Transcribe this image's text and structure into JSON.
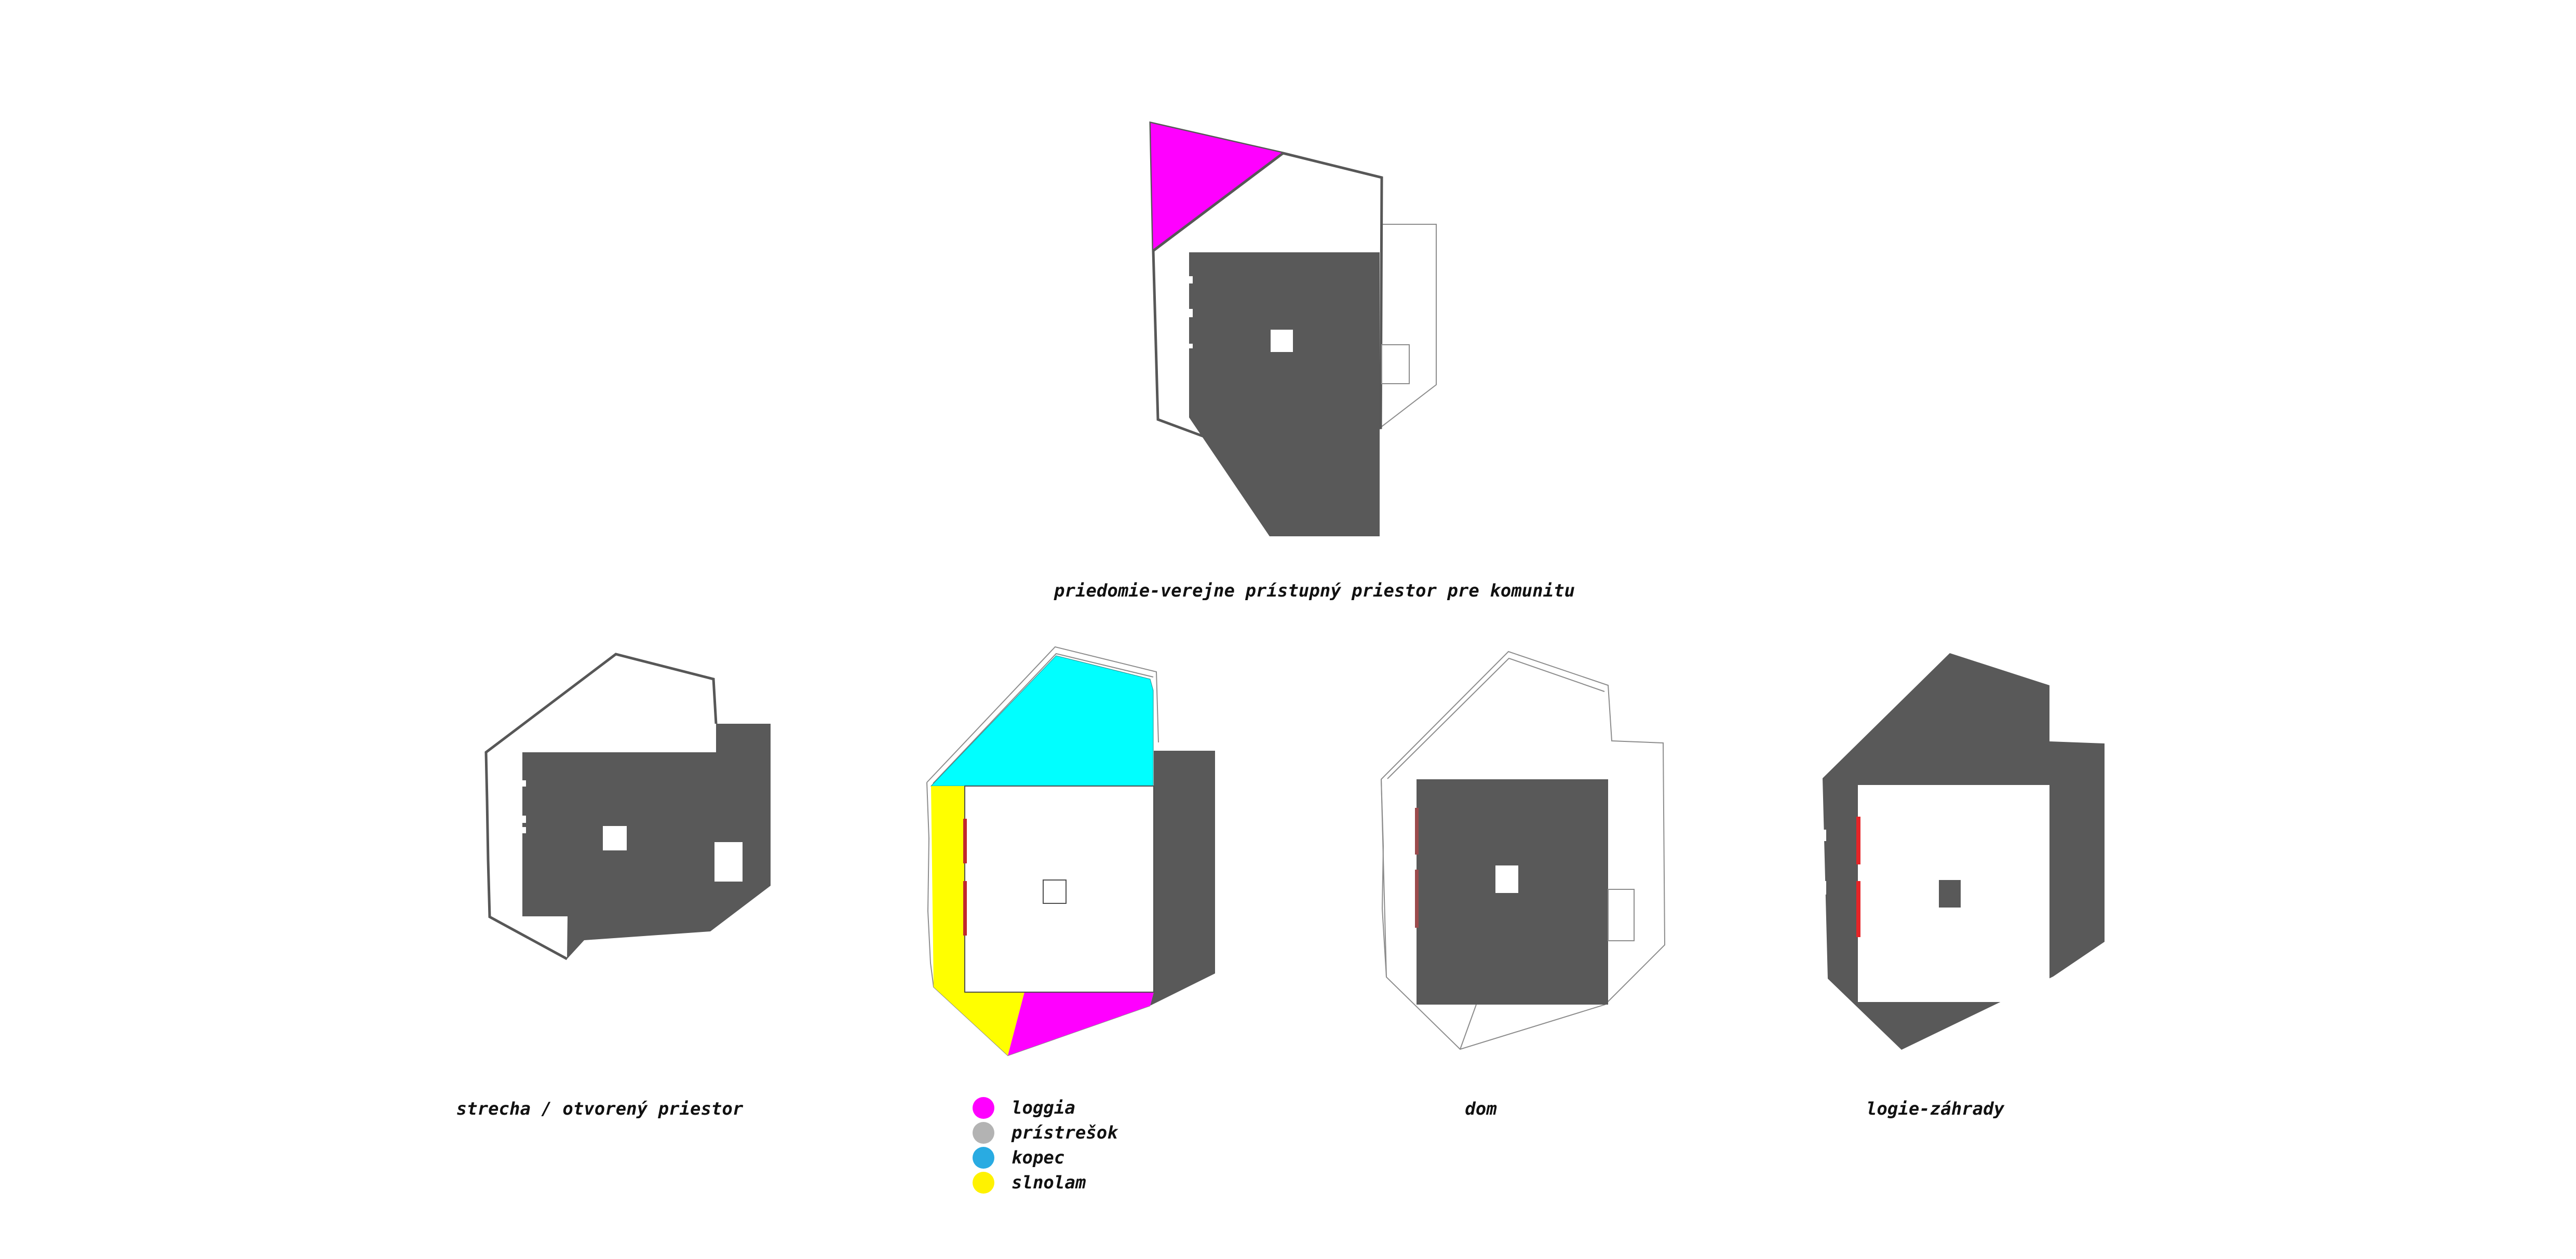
{
  "page": {
    "background": "#ffffff"
  },
  "colors": {
    "dark_gray": "#595959",
    "outline_thick": "#575757",
    "outline_thin": "#8c8c8c",
    "building_line": "#4d4d4d",
    "magenta": "#ff00ff",
    "cyan": "#00ffff",
    "yellow": "#ffff00",
    "red_bright": "#e52528",
    "red_mid": "#c1272d",
    "red_muted": "#9a4a4c",
    "white": "#ffffff"
  },
  "figures": {
    "priedomie": {
      "caption": "priedomie-verejne prístupný priestor pre komunitu"
    },
    "strecha": {
      "caption": "strecha / otvorený priestor"
    },
    "dom": {
      "caption": "dom"
    },
    "logie": {
      "caption": "logie-záhrady"
    }
  },
  "legend": {
    "items": [
      {
        "label": "loggia",
        "color": "#ff00ff"
      },
      {
        "label": "prístrešok",
        "color": "#b3b3b3"
      },
      {
        "label": "kopec",
        "color": "#29abe2"
      },
      {
        "label": "slnolam",
        "color": "#fff200"
      }
    ]
  }
}
